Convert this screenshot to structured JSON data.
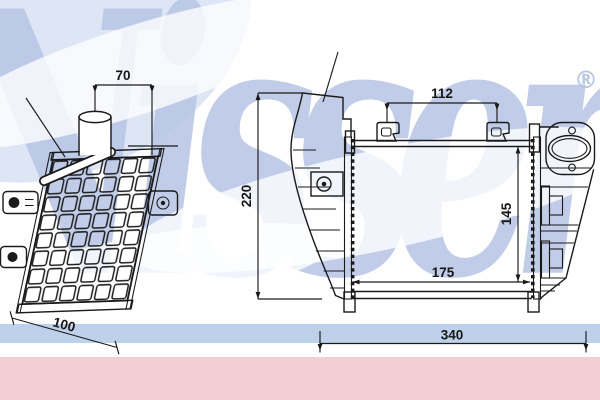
{
  "brand": {
    "watermark_text": "Nissens",
    "registered_symbol": "®"
  },
  "colors": {
    "line": "#1a1a1a",
    "watermark_blue": "#b7c5e5",
    "band_blue": "#bdd2ea",
    "band_pink": "#f3cfd4"
  },
  "views": {
    "perspective": {
      "dims": {
        "pipe_offset": "70",
        "depth": "100"
      }
    },
    "front": {
      "dims": {
        "bracket_spacing": "112",
        "height_overall": "220",
        "core_height": "145",
        "core_width": "175",
        "width_overall": "340"
      }
    }
  }
}
